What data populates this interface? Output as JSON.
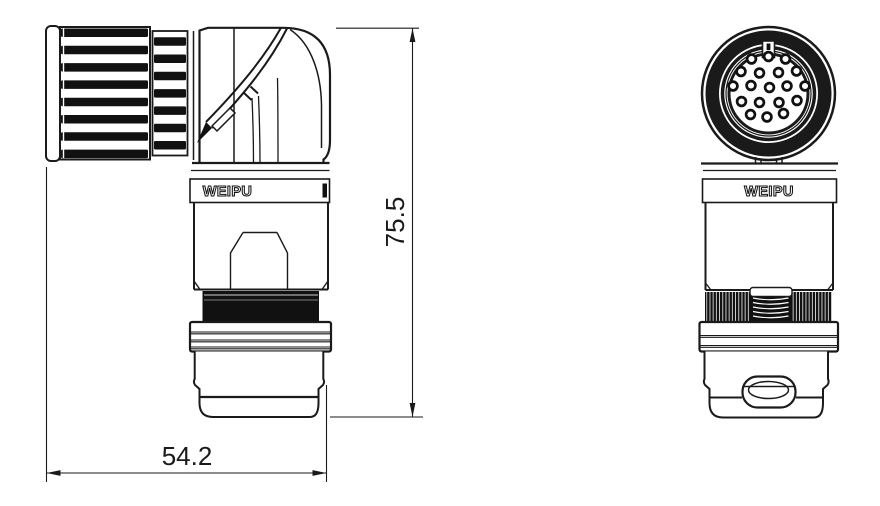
{
  "drawing": {
    "brand": "WEIPU",
    "line_color": "#1a1a1a",
    "background": "#ffffff",
    "views": {
      "side": {
        "label": "WEIPU"
      },
      "front": {
        "label": "WEIPU"
      }
    },
    "dims": {
      "height": "75.5",
      "width": "54.2"
    },
    "front_face": {
      "pin_count": 19,
      "pin_rows": [
        3,
        4,
        5,
        4,
        3
      ],
      "pin_style": {
        "radius": 4.4,
        "ring_stroke": 2.7
      },
      "pins": [
        [
          751.5,
          59
        ],
        [
          768.5,
          56.5
        ],
        [
          785.5,
          59
        ],
        [
          741,
          71.5
        ],
        [
          759.5,
          73
        ],
        [
          778.5,
          72.5
        ],
        [
          796.5,
          71
        ],
        [
          733,
          86
        ],
        [
          751,
          85.5
        ],
        [
          769.5,
          87.5
        ],
        [
          787,
          86
        ],
        [
          805,
          86
        ],
        [
          741.5,
          101.5
        ],
        [
          759.5,
          102.5
        ],
        [
          779,
          102.5
        ],
        [
          797,
          100.5
        ],
        [
          750.5,
          114.5
        ],
        [
          767,
          117
        ],
        [
          783.5,
          113.5
        ]
      ]
    }
  }
}
